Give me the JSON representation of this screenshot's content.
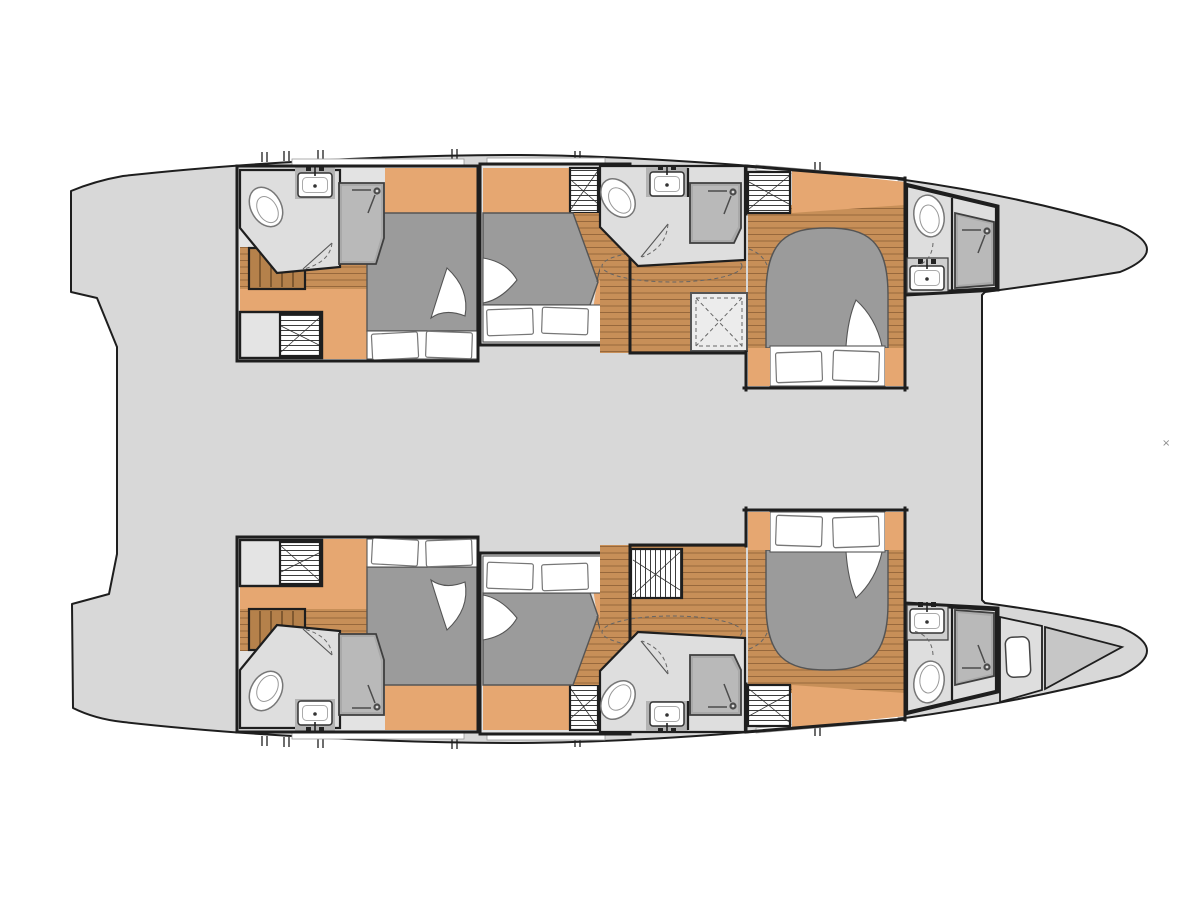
{
  "meta": {
    "title": "Catamaran interior deck plan",
    "view": "top-down layout of two hulls, sterns left and bows right",
    "hulls": 2
  },
  "watermark": {
    "glyph": "×"
  },
  "colors": {
    "bg": "#ffffff",
    "deck": "#d8d8d8",
    "floor": "#e3e3e3",
    "bath": "#dedede",
    "line": "#1e1e1e",
    "furn": "#555555",
    "wood": "#e6a771",
    "plank": "#c78f58",
    "plankLine": "#97683c",
    "stair": "#b5814b",
    "stairLine": "#6f4c28",
    "mattress": "#9b9b9b",
    "shower": "#a9a9a9",
    "showerLight": "#b9b9b9",
    "alcove": "#b3b3b3",
    "wedge": "#c6c6c6",
    "dash": "#666666"
  },
  "inventory": {
    "double_cabins": 6,
    "bathrooms": 6,
    "toilets": 6,
    "showers": 6,
    "sinks": 6,
    "wardrobes": 6,
    "staircases": 2,
    "deck_hatches": 1,
    "forepeak_berths": 1,
    "rooms": [
      "port-aft-cabin",
      "port-mid-cabin",
      "port-fwd-cabin",
      "port-mid-bathroom",
      "port-bow-bathroom",
      "starboard-aft-cabin",
      "starboard-mid-cabin",
      "starboard-fwd-cabin",
      "starboard-mid-bathroom",
      "starboard-bow-bathroom",
      "forepeak-berth"
    ]
  }
}
